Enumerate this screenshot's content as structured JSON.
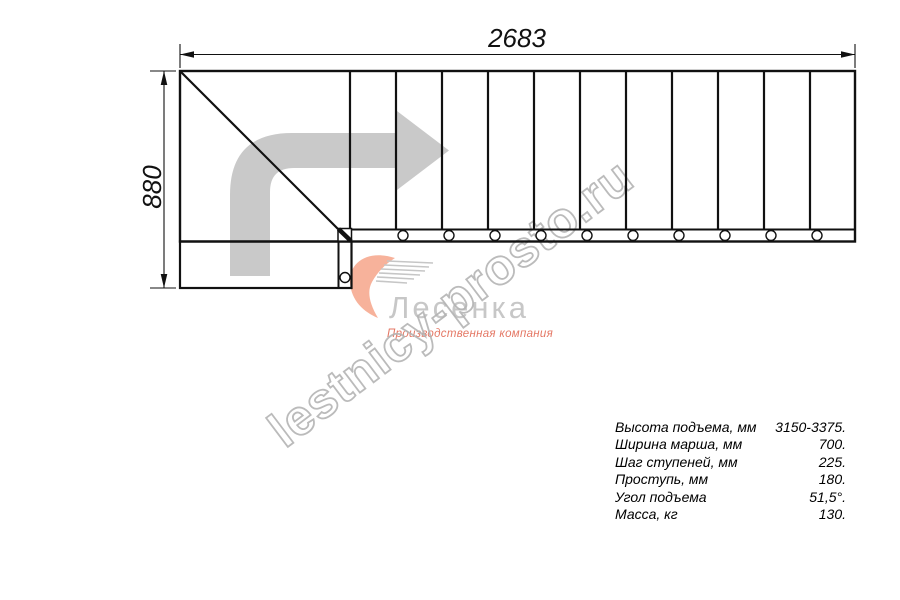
{
  "drawing": {
    "width_mm": "2683",
    "height_mm": "880",
    "tread_count": 11,
    "view": "stair-plan-top-view"
  },
  "watermark": {
    "text": "lestnicy-prosto.ru"
  },
  "logo": {
    "brand": "Лесенка",
    "tagline": "Производственная компания"
  },
  "specs": {
    "rows": [
      {
        "label": "Высота подъема, мм",
        "value": "3150-3375."
      },
      {
        "label": "Ширина марша, мм",
        "value": "700."
      },
      {
        "label": "Шаг ступеней, мм",
        "value": "225."
      },
      {
        "label": "Проступь, мм",
        "value": "180."
      },
      {
        "label": "Угол подъема",
        "value": "51,5°."
      },
      {
        "label": "Масса, кг",
        "value": "130."
      }
    ]
  },
  "colors": {
    "line": "#111111",
    "direction_arrow_gray": "#c9c9c9",
    "watermark_gray": "#b4b4b4",
    "logo_text_gray": "#c7c7c7",
    "logo_accent_red": "#e0604a",
    "logo_peach": "#f6aa90"
  }
}
